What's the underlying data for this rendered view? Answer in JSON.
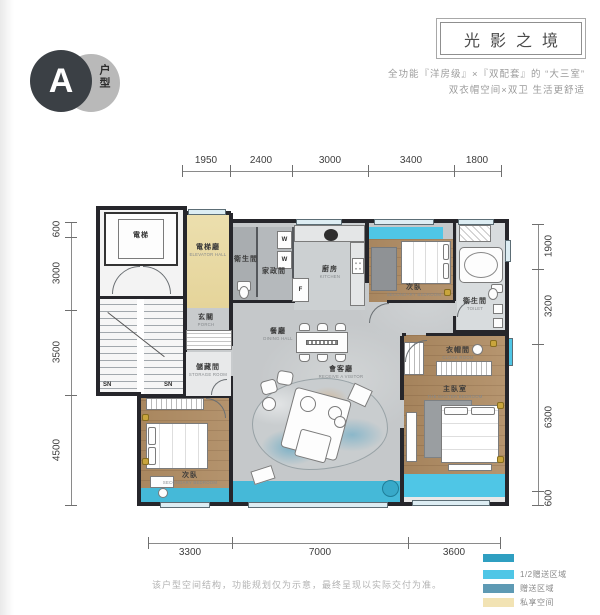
{
  "header": {
    "badge_letter": "A",
    "badge_label": "户型",
    "title": "光影之境",
    "subtitle1": "全功能『洋房级』×『双配套』的 “大三室”",
    "subtitle2": "双衣帽空间×双卫 生活更舒适"
  },
  "dims": {
    "top": [
      "1950",
      "2400",
      "3000",
      "3400",
      "1800"
    ],
    "left": [
      "600",
      "3000",
      "3500",
      "4500"
    ],
    "right": [
      "1900",
      "3200",
      "6300",
      "600"
    ],
    "bottom": [
      "3300",
      "7000",
      "3600"
    ]
  },
  "rooms": {
    "elevator": {
      "cn": "電梯",
      "en": ""
    },
    "elevator_hall": {
      "cn": "電梯廳",
      "en": "ELEVATOR HALL"
    },
    "wc1": {
      "cn": "衛生間",
      "en": "TOILET"
    },
    "housekeeping": {
      "cn": "家政間",
      "en": ""
    },
    "kitchen": {
      "cn": "廚房",
      "en": "KITCHEN"
    },
    "bedroom_top": {
      "cn": "次臥",
      "en": "SECONDARY BEDROOM"
    },
    "bath2": {
      "cn": "衛生間",
      "en": "TOILET"
    },
    "porch": {
      "cn": "玄關",
      "en": "PORCH"
    },
    "dining": {
      "cn": "餐廳",
      "en": "DINING HALL"
    },
    "storage": {
      "cn": "儲藏間",
      "en": "STORAGE ROOM"
    },
    "living": {
      "cn": "會客廳",
      "en": "RECEIVE A VISITOR"
    },
    "cloak": {
      "cn": "衣帽間",
      "en": "CLOAK ROOM"
    },
    "master": {
      "cn": "主臥室",
      "en": "THE MASTER BEDROOM"
    },
    "bedroom_bl": {
      "cn": "次臥",
      "en": "SECONDARY BEDROOM"
    }
  },
  "plan_marks": {
    "sn_left": "SN",
    "sn_right": "SN",
    "fridge": "F",
    "washer1": "W",
    "washer2": "W"
  },
  "legend": {
    "accent_color": "#2f9fc1",
    "items": [
      {
        "label": "1/2赠送区域",
        "color": "#4fc6e6"
      },
      {
        "label": "赠送区域",
        "color": "#5e9ab4"
      },
      {
        "label": "私享空间",
        "color": "#f2e3b4"
      }
    ]
  },
  "footer": {
    "disclaimer": "该户型空间结构，功能规划仅为示意，最终呈现以实际交付为准。"
  }
}
